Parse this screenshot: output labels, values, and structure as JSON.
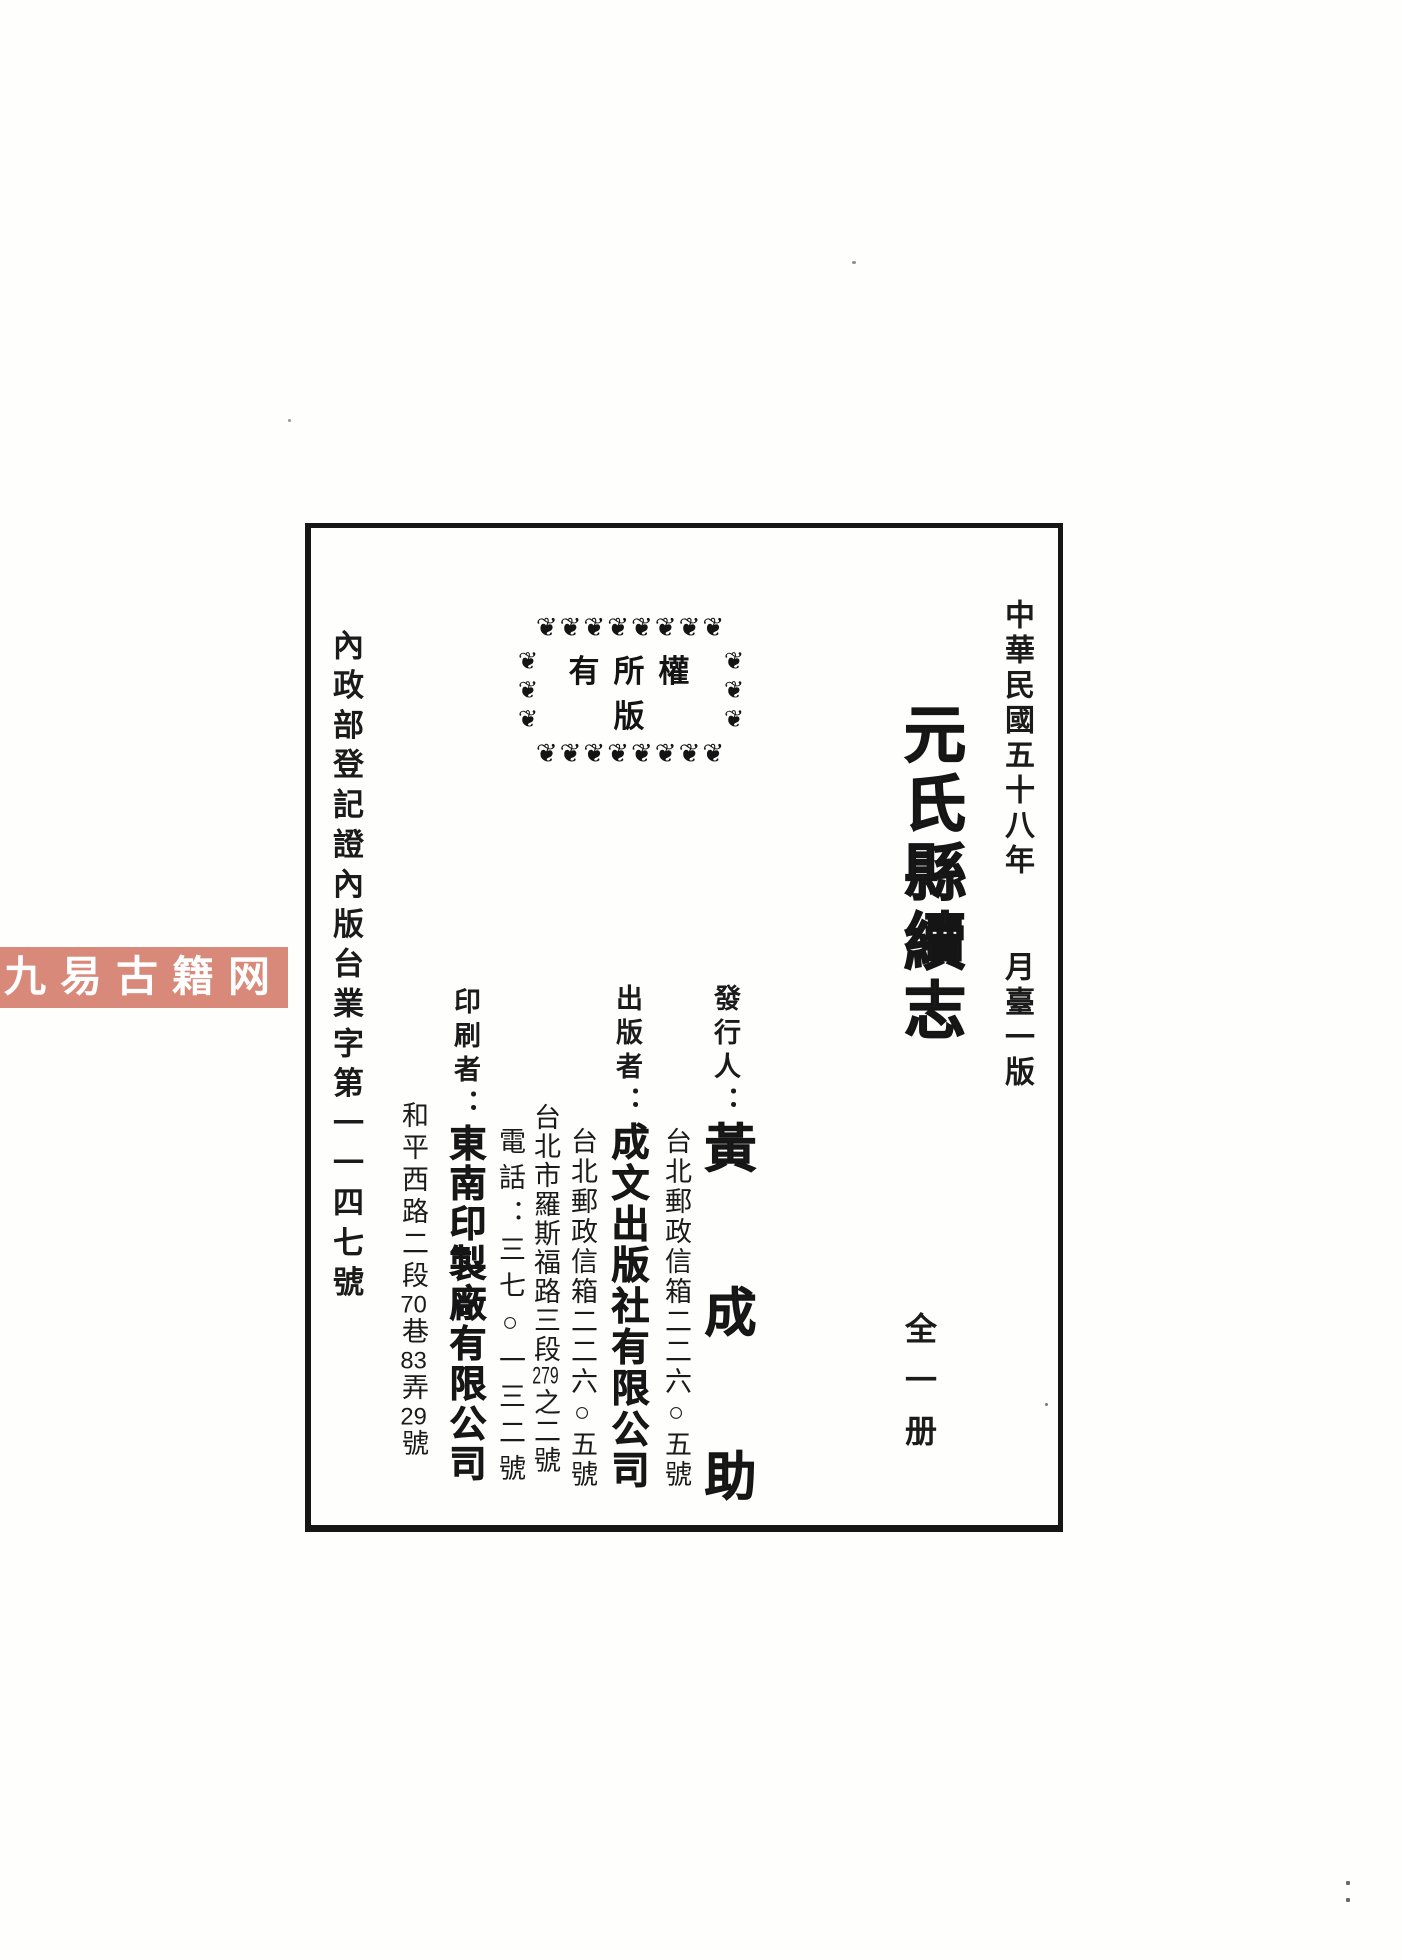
{
  "page_type": "book-colophon-scan",
  "watermark": {
    "text": "九易古籍网",
    "bg_color": "#d8897a",
    "text_color": "#ffffff"
  },
  "edition": {
    "date": "中華民國五十八年",
    "issue": "月臺一版"
  },
  "title": "元氏縣續志",
  "volume": "全一册",
  "stamp": {
    "text": "有所權版",
    "ornament_glyph": "floral-ornament",
    "ornament_row": "❦❦❦❦❦❦❦❦",
    "ornament_side": "❦❦❦"
  },
  "registration": "內政部登記證內版台業字第一一四七號",
  "issuer": {
    "label": "發行人：",
    "name": "黃成助",
    "address": "台北郵政信箱二二六○五號"
  },
  "publisher": {
    "label": "出版者：",
    "name": "成文出版社有限公司",
    "po_box": "台北郵政信箱二二六○五號",
    "street": {
      "pre": "台北市羅斯福路三段",
      "num": "279",
      "post": "之二號"
    },
    "phone": "電話：三七○一三二號"
  },
  "printer": {
    "label": "印刷者：",
    "name": "東南印製廠有限公司",
    "address": {
      "pre": "和平西路二段",
      "num1": "70",
      "sep1": "巷",
      "num2": "83",
      "sep2": "弄",
      "num3": "29",
      "post": "號"
    }
  }
}
